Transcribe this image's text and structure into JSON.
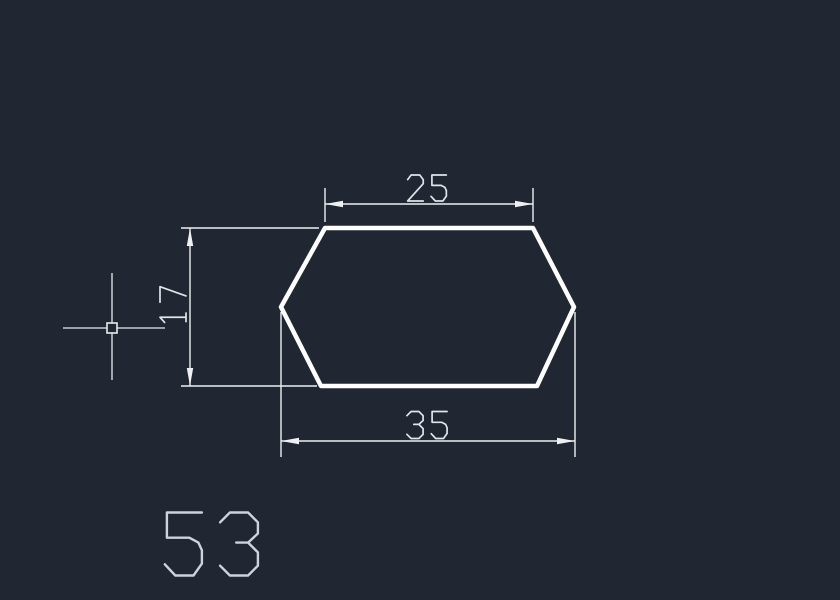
{
  "app": {
    "name": "cad-model-space",
    "background_color": "#212732"
  },
  "drawing": {
    "shape": {
      "name": "hexagon-profile",
      "stroke_color": "#ffffff",
      "stroke_width": 4.5,
      "points": [
        [
          325,
          228
        ],
        [
          533,
          228
        ],
        [
          574,
          307
        ],
        [
          537,
          386
        ],
        [
          321,
          386
        ],
        [
          281,
          307
        ]
      ]
    },
    "dim_style": {
      "line_color": "#eef0f2",
      "line_width": 1.4,
      "text_color": "#dfe4e9",
      "text_stroke_width": 1.7,
      "arrow_length": 18,
      "arrow_half_width": 3.2
    },
    "dimensions": [
      {
        "id": "top-width",
        "value": "25",
        "orientation": "horizontal",
        "line": {
          "x1": 325,
          "y1": 204,
          "x2": 533,
          "y2": 204
        },
        "ext_lines": [
          {
            "x1": 325,
            "y1": 188,
            "x2": 325,
            "y2": 222
          },
          {
            "x1": 533,
            "y1": 188,
            "x2": 533,
            "y2": 222
          }
        ],
        "arrows": [
          {
            "x": 325,
            "y": 204,
            "dir": "left"
          },
          {
            "x": 533,
            "y": 204,
            "dir": "right"
          }
        ],
        "text": {
          "x": 427,
          "y": 188,
          "cap_height": 26,
          "rotation": 0
        }
      },
      {
        "id": "overall-width",
        "value": "35",
        "orientation": "horizontal",
        "line": {
          "x1": 281,
          "y1": 441,
          "x2": 575,
          "y2": 441
        },
        "ext_lines": [
          {
            "x1": 281,
            "y1": 312,
            "x2": 281,
            "y2": 457
          },
          {
            "x1": 575,
            "y1": 312,
            "x2": 575,
            "y2": 457
          }
        ],
        "arrows": [
          {
            "x": 281,
            "y": 441,
            "dir": "left"
          },
          {
            "x": 575,
            "y": 441,
            "dir": "right"
          }
        ],
        "text": {
          "x": 427,
          "y": 425,
          "cap_height": 27,
          "rotation": 0
        }
      },
      {
        "id": "height",
        "value": "17",
        "orientation": "vertical",
        "line": {
          "x1": 190,
          "y1": 228,
          "x2": 190,
          "y2": 386
        },
        "ext_lines": [
          {
            "x1": 181,
            "y1": 228,
            "x2": 319,
            "y2": 228
          },
          {
            "x1": 181,
            "y1": 386,
            "x2": 317,
            "y2": 386
          }
        ],
        "arrows": [
          {
            "x": 190,
            "y": 228,
            "dir": "up"
          },
          {
            "x": 190,
            "y": 386,
            "dir": "down"
          }
        ],
        "text": {
          "x": 173,
          "y": 306,
          "cap_height": 26,
          "rotation": -90
        }
      }
    ],
    "part_label": {
      "value": "53",
      "x": 211,
      "y": 544,
      "cap_height": 63,
      "color": "#ccd3dc",
      "stroke_width": 2.4
    }
  },
  "cursor": {
    "name": "crosshair",
    "x": 112,
    "y": 328,
    "h_arm_x1": 63,
    "h_arm_x2": 165,
    "v_arm_y1": 273,
    "v_arm_y2": 380,
    "pickbox_size": 10,
    "color": "#e9ecef",
    "line_width": 1.3,
    "pickbox_stroke_width": 1.6
  }
}
